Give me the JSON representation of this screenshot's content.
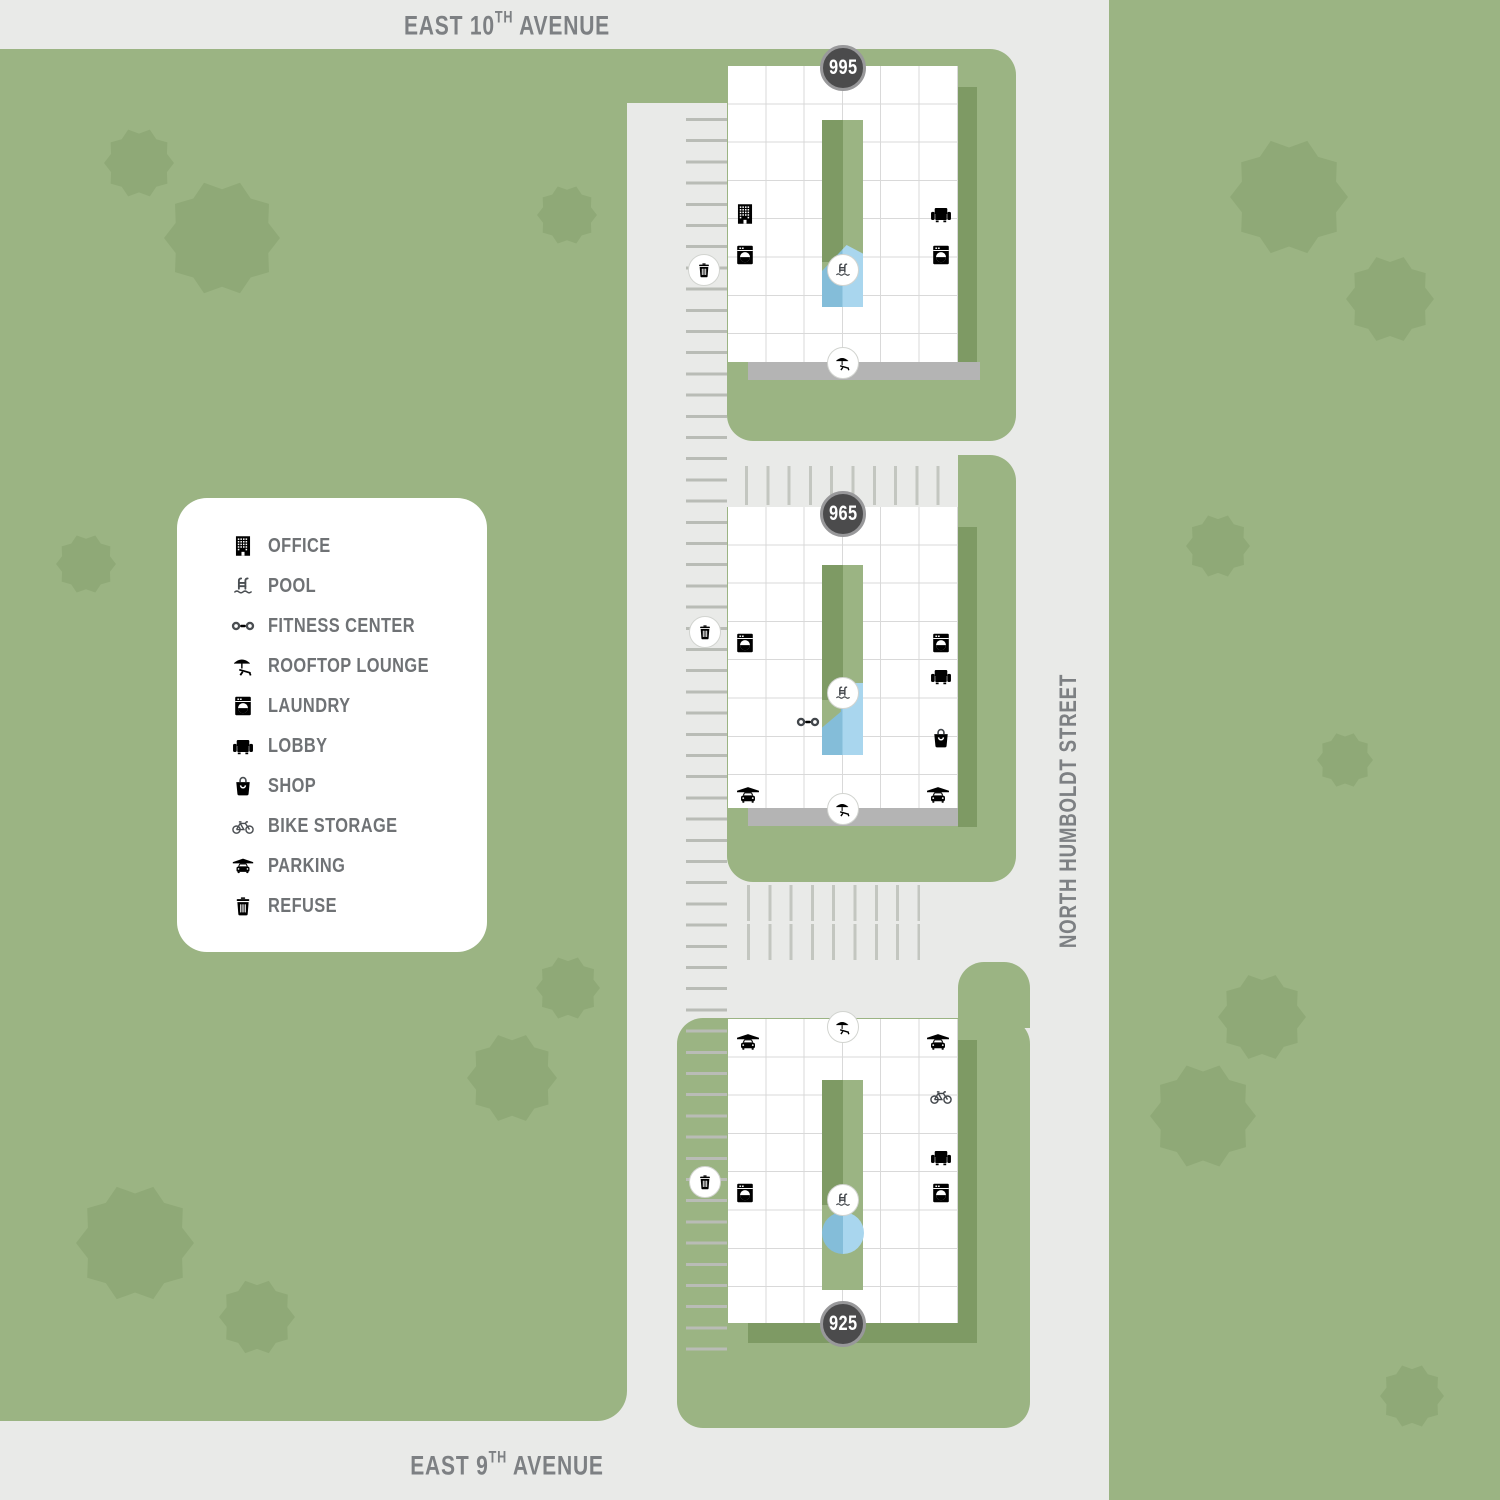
{
  "streets": {
    "top": {
      "prefix": "EAST 10",
      "sup": "TH",
      "suffix": " AVENUE"
    },
    "bottom": {
      "prefix": "EAST 9",
      "sup": "TH",
      "suffix": " AVENUE"
    },
    "right": {
      "label": "NORTH HUMBOLDT STREET"
    }
  },
  "buildings": [
    {
      "number": "995",
      "amenities": [
        "office",
        "laundry",
        "lobby",
        "laundry",
        "pool",
        "rooftop-lounge",
        "refuse"
      ]
    },
    {
      "number": "965",
      "amenities": [
        "laundry",
        "laundry",
        "lobby",
        "shop",
        "fitness-center",
        "pool",
        "rooftop-lounge",
        "parking",
        "parking",
        "refuse"
      ]
    },
    {
      "number": "925",
      "amenities": [
        "rooftop-lounge",
        "parking",
        "parking",
        "bike-storage",
        "lobby",
        "laundry",
        "laundry",
        "pool",
        "refuse"
      ]
    }
  ],
  "legend": {
    "items": [
      {
        "icon": "office-icon",
        "label": "OFFICE"
      },
      {
        "icon": "pool-icon",
        "label": "POOL"
      },
      {
        "icon": "fitness-center-icon",
        "label": "FITNESS CENTER"
      },
      {
        "icon": "rooftop-lounge-icon",
        "label": "ROOFTOP LOUNGE"
      },
      {
        "icon": "laundry-icon",
        "label": "LAUNDRY"
      },
      {
        "icon": "lobby-icon",
        "label": "LOBBY"
      },
      {
        "icon": "shop-icon",
        "label": "SHOP"
      },
      {
        "icon": "bike-storage-icon",
        "label": "BIKE STORAGE"
      },
      {
        "icon": "parking-icon",
        "label": "PARKING"
      },
      {
        "icon": "refuse-icon",
        "label": "REFUSE"
      }
    ]
  },
  "colors": {
    "lawn_green": "#9bb483",
    "tree_green": "#8fa977",
    "shadow_green": "#7e9a64",
    "street_gray": "#e9eae8",
    "building_white": "#ffffff",
    "grid_line": "#d9d9d9",
    "icon_dark": "#42464b",
    "badge_bg": "#4b4b4c",
    "pool_light": "#a9d6ee",
    "pool_dark": "#84bdd9",
    "label_gray": "#7d8083"
  }
}
